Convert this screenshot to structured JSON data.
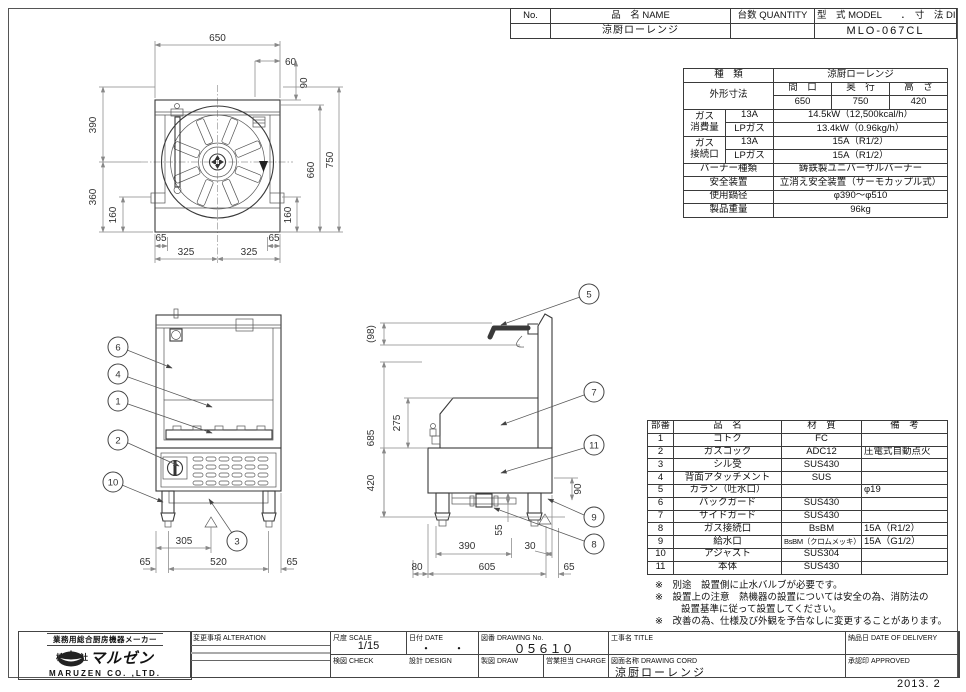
{
  "header": {
    "no_label": "No.",
    "name_label": "品　名 NAME",
    "qty_label": "台数 QUANTITY",
    "model_dim_label": "型　式 MODEL　　．　寸　法 DIMENSION",
    "name_value": "涼厨ローレンジ",
    "model_value": "MLO-067CL"
  },
  "spec": {
    "kind_label": "種　類",
    "kind_value": "涼厨ローレンジ",
    "outline_label": "外形寸法",
    "w_label": "間　口",
    "d_label": "奥　行",
    "h_label": "高　さ",
    "w_value": "650",
    "d_value": "750",
    "h_value": "420",
    "gas1": "ガス",
    "gas2": "消費量",
    "t13a": "13A",
    "lpg": "LPガス",
    "cons_13a": "14.5kW（12,500kcal/h）",
    "cons_lp": "13.4kW（0.96kg/h）",
    "conn1": "ガス",
    "conn2": "接続口",
    "conn_13a": "15A（R1/2）",
    "conn_lp": "15A（R1/2）",
    "burner_label": "バーナー種類",
    "burner_value": "鋳鉄製ユニバーサルバーナー",
    "safety_label": "安全装置",
    "safety_value": "立消え安全装置（サーモカップル式）",
    "pot_label": "使用鍋径",
    "pot_value": "φ390～φ510",
    "weight_label": "製品重量",
    "weight_value": "96kg"
  },
  "parts": {
    "h_no": "部番",
    "h_name": "品　名",
    "h_mat": "材　質",
    "h_note": "備　考",
    "rows": [
      {
        "no": "1",
        "name": "ゴトク",
        "mat": "FC",
        "note": ""
      },
      {
        "no": "2",
        "name": "ガスコック",
        "mat": "ADC12",
        "note": "圧電式自動点火"
      },
      {
        "no": "3",
        "name": "シル受",
        "mat": "SUS430",
        "note": ""
      },
      {
        "no": "4",
        "name": "背面アタッチメント",
        "mat": "SUS",
        "note": ""
      },
      {
        "no": "5",
        "name": "カラン（吐水口）",
        "mat": "",
        "note": "φ19"
      },
      {
        "no": "6",
        "name": "バックガード",
        "mat": "SUS430",
        "note": ""
      },
      {
        "no": "7",
        "name": "サイドガード",
        "mat": "SUS430",
        "note": ""
      },
      {
        "no": "8",
        "name": "ガス接続口",
        "mat": "BsBM",
        "note": "15A（R1/2）"
      },
      {
        "no": "9",
        "name": "給水口",
        "mat": "BsBM（クロムメッキ）",
        "note": "15A（G1/2）"
      },
      {
        "no": "10",
        "name": "アジャスト",
        "mat": "SUS304",
        "note": ""
      },
      {
        "no": "11",
        "name": "本体",
        "mat": "SUS430",
        "note": ""
      }
    ]
  },
  "notes": [
    "※　別途　設置側に止水バルブが必要です。",
    "※　設置上の注意　熱機器の設置については安全の為、消防法の",
    "設置基準に従って設置してください。",
    "※　改善の為、仕様及び外観を予告なしに変更することがあります。"
  ],
  "titleblock": {
    "alteration_label": "変更事項 ALTERATION",
    "scale_label": "尺度 SCALE",
    "scale_value": "1/15",
    "date_label": "日付 DATE",
    "date_value": "・　　・",
    "dno_label": "図番 DRAWING No.",
    "dno_value": "０５６１０",
    "title_label": "工事名 TITLE",
    "delivery_label": "納品日 DATE OF DELIVERY",
    "check_label": "検図 CHECK",
    "design_label": "設計 DESIGN",
    "draw_label": "製図 DRAW",
    "charge_label": "営業担当 CHARGE",
    "cord_label": "図面名称 DRAWING CORD",
    "cord_value": "涼厨ローレンジ",
    "approved_label": "承認印 APPROVED",
    "date_stamp": "2013. 2"
  },
  "company": {
    "tagline": "業務用総合厨房機器メーカー",
    "prefix": "株式会社",
    "brand": "マルゼン",
    "name_en": "MARUZEN  CO. ,LTD."
  },
  "dims": {
    "650": "650",
    "60": "60",
    "90": "90",
    "390": "390",
    "360": "360",
    "160": "160",
    "660": "660",
    "750": "750",
    "65": "65",
    "325": "325",
    "305": "305",
    "520": "520",
    "98": "(98)",
    "685": "685",
    "275": "275",
    "420": "420",
    "55": "55",
    "30": "30",
    "80": "80",
    "605": "605"
  },
  "balloons": {
    "1": "1",
    "2": "2",
    "3": "3",
    "4": "4",
    "5": "5",
    "6": "6",
    "7": "7",
    "8": "8",
    "9": "9",
    "10": "10",
    "11": "11"
  }
}
